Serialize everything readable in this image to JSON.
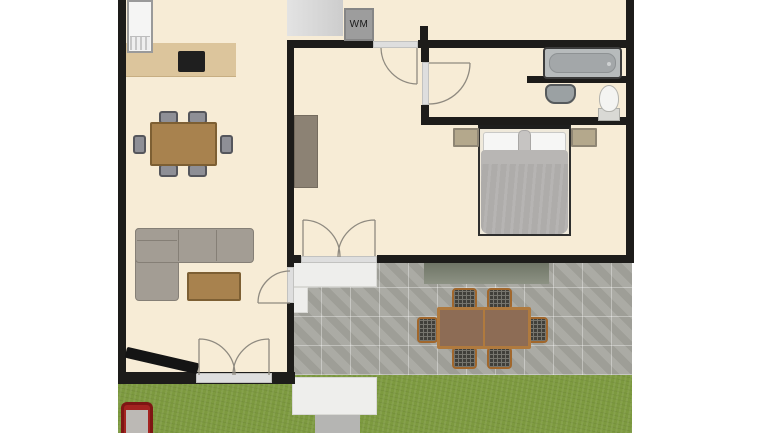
{
  "labels": {
    "washing_machine": "WM"
  },
  "colors": {
    "floor": "#f7ecd6",
    "wall": "#1d1c1a",
    "grass": "#7d9a40",
    "patio_tile": "#a6a69f",
    "counter": "#dcc59c",
    "wood": "#a8824e",
    "sofa": "#a39d94",
    "bed": "#aeacaa",
    "threshold": "#dedede",
    "appliance_gray": "#9d9d9d",
    "grill_red": "#a32320",
    "awning_green": "#7d8373"
  }
}
